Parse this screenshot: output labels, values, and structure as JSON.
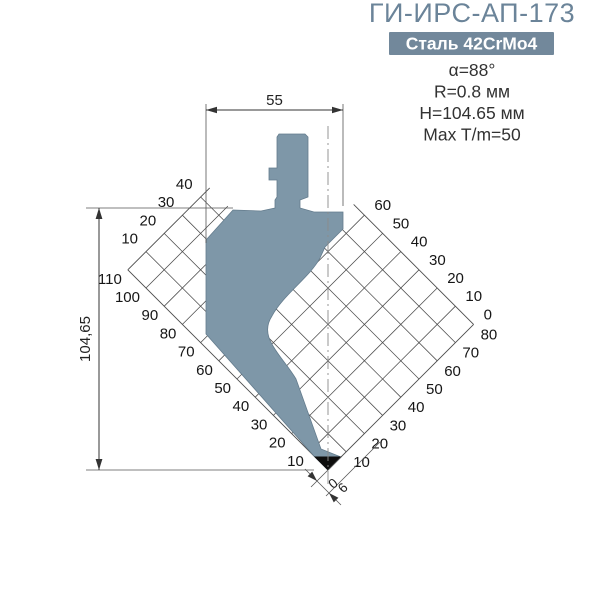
{
  "header": {
    "title": "ГИ-ИРС-АП-173",
    "material_badge": "Сталь 42CrMo4",
    "specs": [
      "α=88°",
      "R=0.8 мм",
      "H=104.65 мм",
      "Max T/m=50"
    ]
  },
  "diagram": {
    "dimensions": {
      "width": "55",
      "height": "104,65",
      "tip_offset": "6",
      "origin": "0"
    },
    "scales": {
      "top_left": [
        10,
        20,
        30,
        40
      ],
      "bottom_left": [
        10,
        20,
        30,
        40,
        50,
        60,
        70,
        80,
        90,
        100,
        110
      ],
      "top_right": [
        0,
        10,
        20,
        30,
        40,
        50,
        60
      ],
      "bottom_right": [
        10,
        20,
        30,
        40,
        50,
        60,
        70,
        80
      ]
    },
    "grid": {
      "cell_mm": 10,
      "right_extent_mm": 80,
      "left_extent_mm": 110
    },
    "colors": {
      "tool_fill": "#7e97a8",
      "tool_outline": "#647c8d",
      "tip_fill": "#0d0d0d",
      "grid_line": "#4c4c4c",
      "accent_title": "#6b8499",
      "badge_bg": "#72889b",
      "badge_text": "#ffffff"
    }
  }
}
